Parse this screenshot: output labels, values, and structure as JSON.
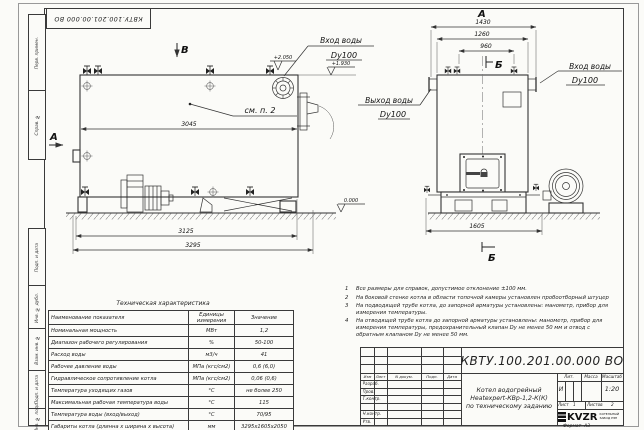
{
  "sheet": {
    "stamp_top": "КВТУ.100.201.00.000 ВО",
    "format_label": "Формат",
    "format_value": "А3"
  },
  "margin": {
    "top_labels": [
      "Перв. примен.",
      "Справ. №"
    ],
    "bottom_labels": [
      "Подп. и дата",
      "Инв. № дубл.",
      "Взам. инв. №",
      "Подп. и дата",
      "Инв. № подл."
    ]
  },
  "views": {
    "side": {
      "section_top": "В",
      "section_left": "А",
      "note_ref": "см. п. 2",
      "inlet_label": "Вход воды",
      "inlet_dn": "Dy100",
      "elev_high": "+2.050",
      "elev_mid": "+1.930",
      "elev_zero": "0.000",
      "dim_inner": "3045",
      "dim_mid": "3125",
      "dim_outer": "3295"
    },
    "front": {
      "label_top": "А",
      "section_top": "Б",
      "section_bottom": "Б",
      "dim_w1": "1430",
      "dim_w2": "1260",
      "dim_w3": "960",
      "dim_base": "1605",
      "inlet_label": "Вход воды",
      "inlet_dn": "Dy100",
      "outlet_label": "Выход воды",
      "outlet_dn": "Dy100"
    }
  },
  "notes": {
    "items": [
      {
        "num": "1",
        "text": "Все размеры для справок, допустимое отклонение ±100 мм."
      },
      {
        "num": "2",
        "text": "На боковой стенке котла в области топочной камеры установлен пробоотборный штуцер"
      },
      {
        "num": "3",
        "text": "На  подводящей трубе котла, до запорной арматуры установлены: манометр, прибор для измерения температуры."
      },
      {
        "num": "4",
        "text": "На отводящей трубе котла до запорной арматуры установлены: манометр, прибор для измерения температуры, предохранительный клапан Dу не менее 50 мм и отвод с обратным клапаном Dу не менее 50 мм."
      }
    ]
  },
  "spec_table": {
    "title": "Техническая характеристика",
    "headers": [
      "Наименование показателя",
      "Единицы измерения",
      "Значение"
    ],
    "rows": [
      [
        "Номинальная мощность",
        "МВт",
        "1,2"
      ],
      [
        "Диапазон рабочего регулирования",
        "%",
        "50-100"
      ],
      [
        "Расход воды",
        "м3/ч",
        "41"
      ],
      [
        "Рабочее давление воды",
        "МПа (кгс/см2)",
        "0,6 (6,0)"
      ],
      [
        "Гидравлическое сопротивление котла",
        "МПа (кгс/см2)",
        "0,06 (0,6)"
      ],
      [
        "Температура уходящих газов",
        "°С",
        "не более 250"
      ],
      [
        "Максимальная рабочая температура воды",
        "°С",
        "115"
      ],
      [
        "Температура воды (вход/выход)",
        "°С",
        "70/95"
      ],
      [
        "Габариты котла (длинна х ширина х высота)",
        "мм",
        "3295х1605х2050"
      ]
    ]
  },
  "title_block": {
    "doc_number": "КВТУ.100.201.00.000 ВО",
    "doc_name_lines": [
      "Котел водогрейный",
      "Heatexpert-КВр-1,2-К(К)",
      "по техническому заданию"
    ],
    "header_row": [
      "Изм",
      "Лист",
      "N докум.",
      "Подп.",
      "Дата"
    ],
    "role_rows": [
      "Разраб.",
      "Пров.",
      "Т.контр.",
      "",
      "Н.контр.",
      "Утв."
    ],
    "lit_header": [
      "Лит.",
      "Масса",
      "Масштаб"
    ],
    "lit_value": "И",
    "scale_value": "1:20",
    "sheet_label": "Лист",
    "sheet_value": "1",
    "sheets_label": "Листов",
    "sheets_value": "2",
    "logo_text": "KVZR",
    "company_lines": [
      "КОТЕЛЬНЫЙ",
      "ЗАВОД РЭП"
    ]
  }
}
